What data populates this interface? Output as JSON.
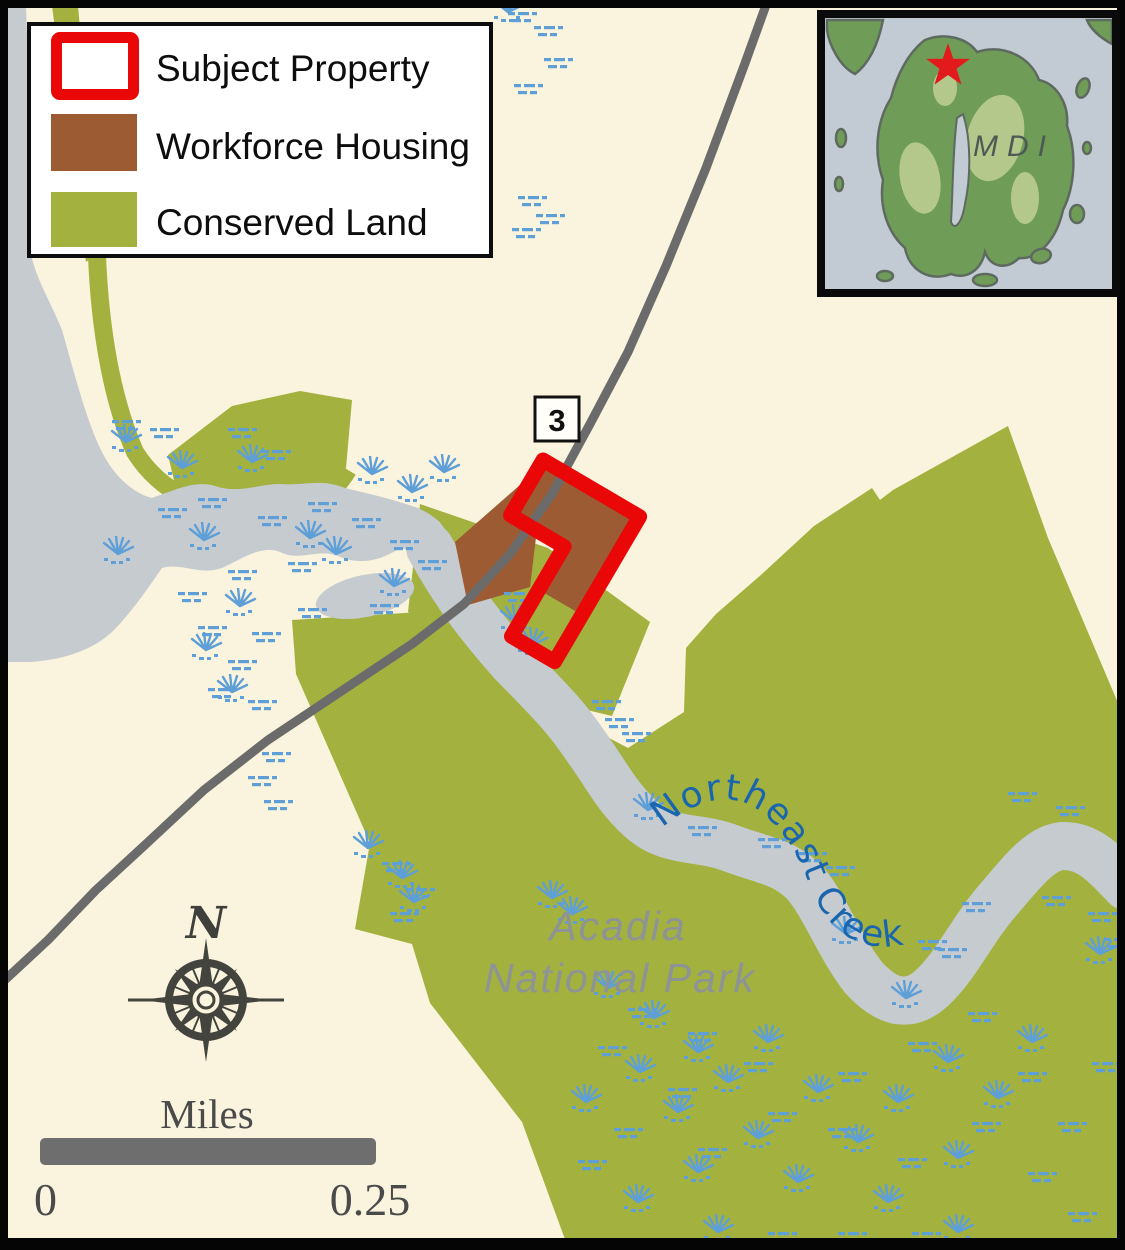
{
  "map": {
    "route_shield": "3",
    "creek_label": "Northeast Creek",
    "park_label_line1": "Acadia",
    "park_label_line2": "National Park",
    "compass_north": "N"
  },
  "legend": {
    "items": [
      {
        "label": "Subject Property",
        "swatch": "red-outline"
      },
      {
        "label": "Workforce Housing",
        "swatch": "brown-fill"
      },
      {
        "label": "Conserved Land",
        "swatch": "green-fill"
      }
    ]
  },
  "inset": {
    "label": "MDI",
    "marker": "red-star"
  },
  "scale_bar": {
    "title": "Miles",
    "start": "0",
    "end": "0.25"
  },
  "colors": {
    "background": "#FAF3DD",
    "conserved_land": "#A3B13E",
    "workforce_housing": "#9D5B33",
    "subject_property_outline": "#E90707",
    "water": "#C6CBD0",
    "road": "#6B6B6B",
    "wetland_symbols": "#5E9FD8",
    "creek_label": "#1966AE",
    "park_label": "#8E9396",
    "inset_water": "#C2CAD4",
    "inset_land": "#6F9D57",
    "locator_star": "#E31A1C"
  }
}
